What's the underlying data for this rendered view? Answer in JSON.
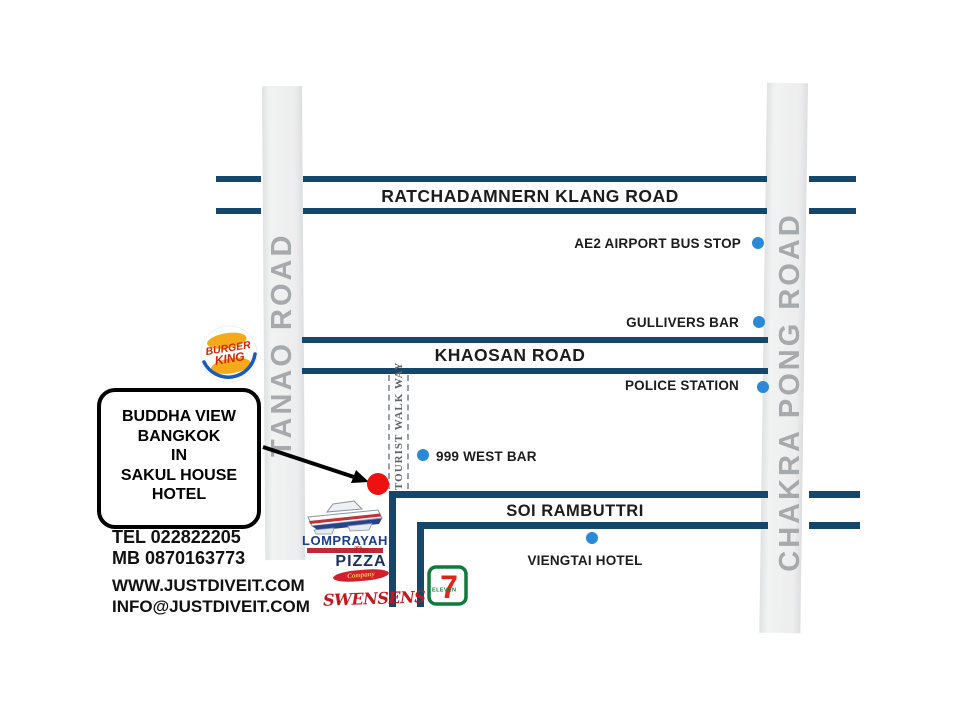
{
  "map": {
    "roads": {
      "ratchadamnern": "RATCHADAMNERN KLANG ROAD",
      "khaosan": "KHAOSAN ROAD",
      "soi_rambuttri": "SOI RAMBUTTRI",
      "tanao": "TANAO ROAD",
      "chakra_pong": "CHAKRA PONG ROAD",
      "tourist_walkway": "TOURIST WALK WAY"
    },
    "pois": {
      "ae2": "AE2 AIRPORT BUS STOP",
      "gullivers": "GULLIVERS BAR",
      "police": "POLICE STATION",
      "west_bar": "999 WEST BAR",
      "viengtai": "VIENGTAI HOTEL"
    },
    "destination": {
      "lines": [
        "BUDDHA VIEW",
        "BANGKOK",
        "IN",
        "SAKUL HOUSE",
        "HOTEL"
      ]
    },
    "contact": {
      "tel": "TEL 022822205",
      "mobile": "MB 0870163773",
      "website": "WWW.JUSTDIVEIT.COM",
      "email": "INFO@JUSTDIVEIT.COM"
    },
    "logos": {
      "burger_king": {
        "line1": "BURGER",
        "line2": "KING"
      },
      "lomprayah": {
        "name": "LOMPRAYAH"
      },
      "pizza_company": {
        "the": "The",
        "pizza": "PIZZA",
        "company": "Company"
      },
      "swensens": {
        "name": "SWENSENS"
      },
      "seven_eleven": {
        "seven": "7",
        "eleven": "ELEVEN"
      }
    },
    "colors": {
      "road_line": "#15466b",
      "road_fill": "#ededee",
      "road_name_text": "#a7aaac",
      "poi_dot": "#2a8ad8",
      "destination_dot": "#ee1111"
    }
  }
}
